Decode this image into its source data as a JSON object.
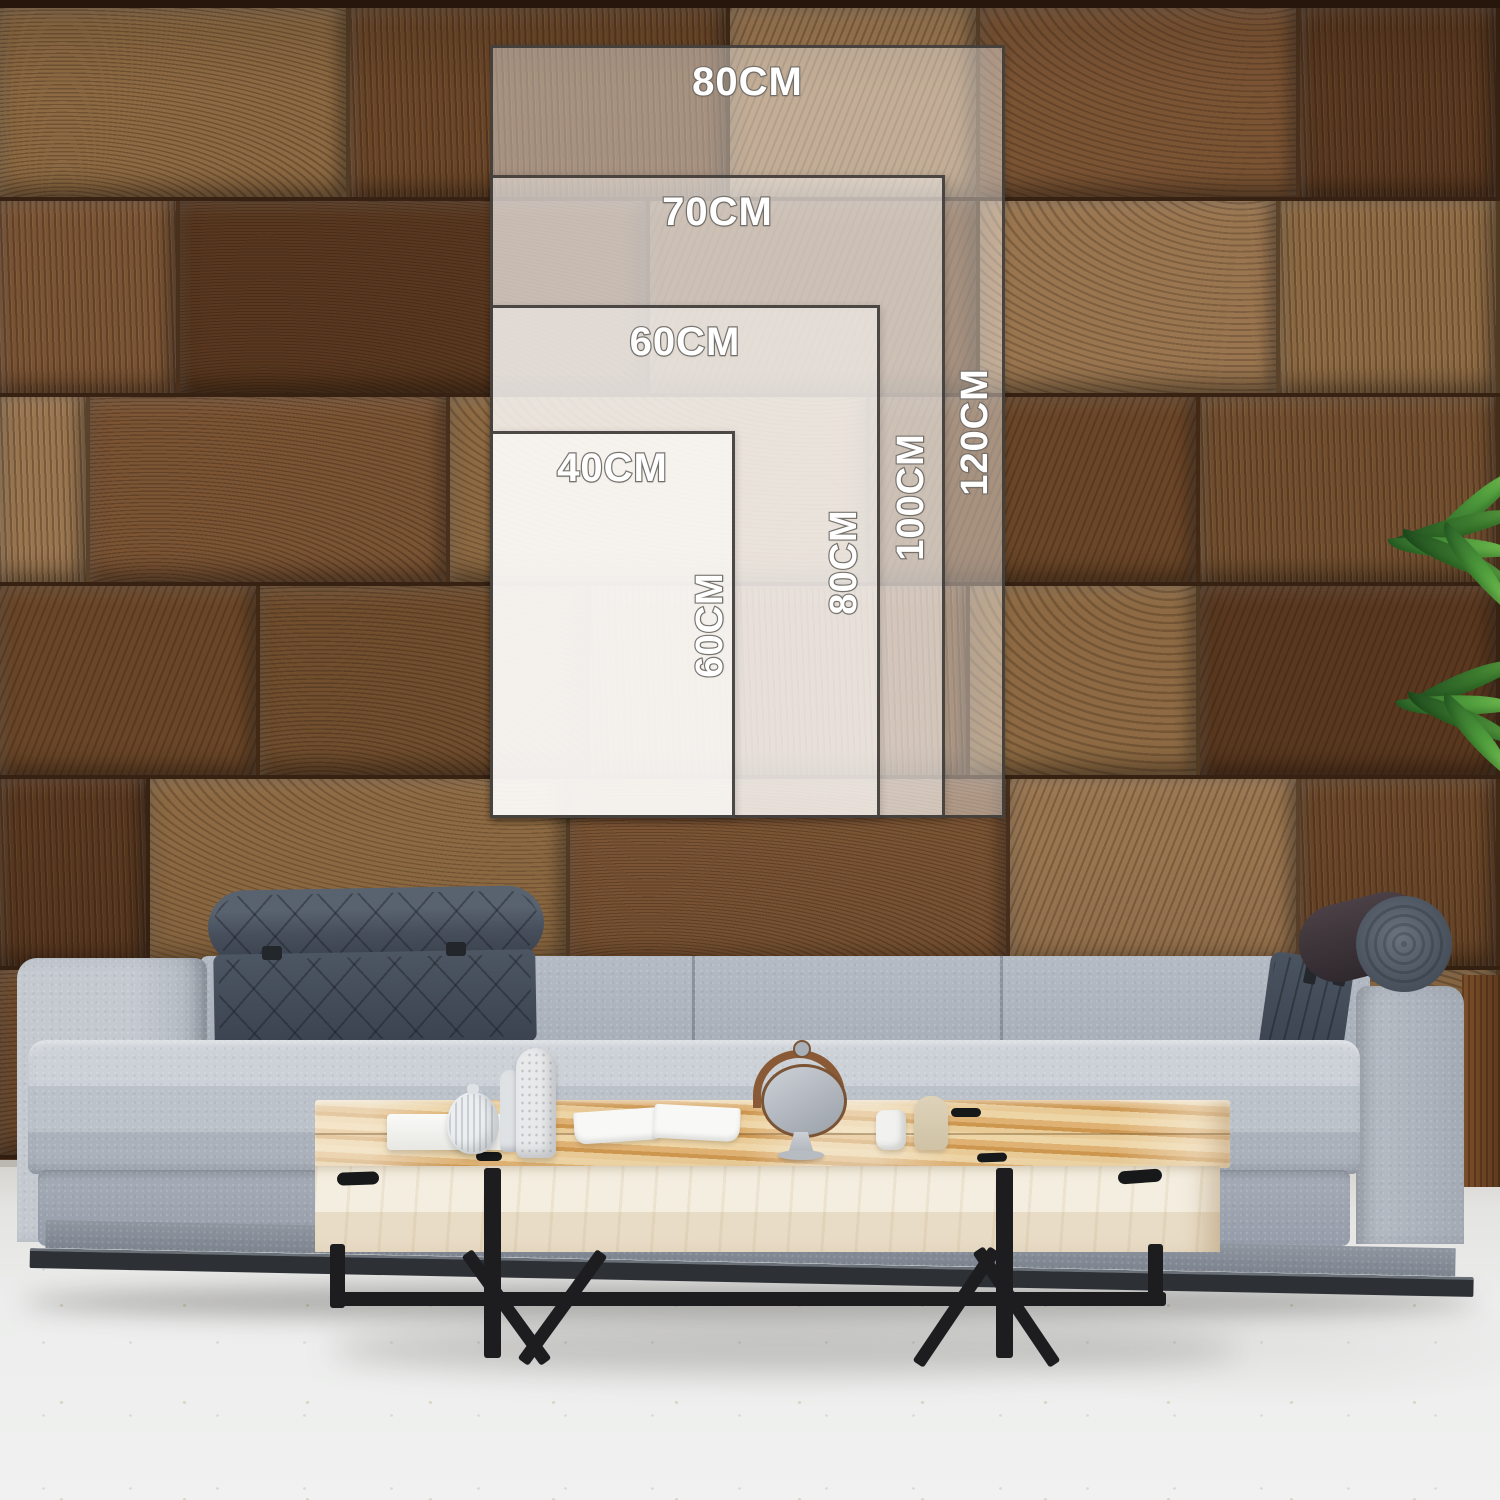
{
  "size_guide": {
    "unit": "CM",
    "options": [
      {
        "width_label": "80CM",
        "height_label": "120CM",
        "width_cm": 80,
        "height_cm": 120
      },
      {
        "width_label": "70CM",
        "height_label": "100CM",
        "width_cm": 70,
        "height_cm": 100
      },
      {
        "width_label": "60CM",
        "height_label": "80CM",
        "width_cm": 60,
        "height_cm": 80
      },
      {
        "width_label": "40CM",
        "height_label": "60CM",
        "width_cm": 40,
        "height_cm": 60
      }
    ]
  },
  "colors": {
    "frame_border": "#3e3a36",
    "label_text": "#ffffff",
    "label_outline": "#75716c",
    "wall_wood": "#7b5434",
    "sofa_fabric": "#b7bdc5",
    "headrest": "#3d4650",
    "table_top_wood": "#e2bd85",
    "table_front_wood": "#f0e8d6",
    "metal_legs": "#1d1d20",
    "floor": "#eeece7",
    "plant_green": "#4f9c3c"
  }
}
